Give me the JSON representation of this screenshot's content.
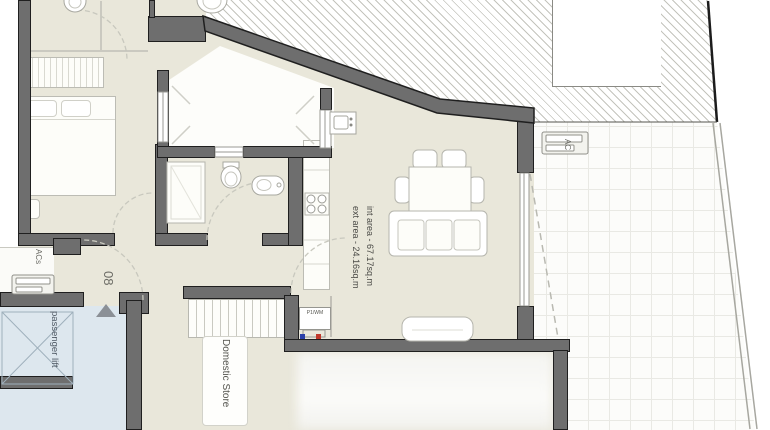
{
  "plan": {
    "title": "apartment-floor-plan",
    "int_area_label": "int area - 67.17sq.m",
    "ext_area_label": "ext area - 24.16sq.m",
    "unit_number": "08",
    "lift_label": "passenger lift",
    "store_label": "Domestic Store",
    "ac_unit_terrace_label": "AC",
    "ac_unit_facade_label": "ACs",
    "washer_label": "P1/WM"
  },
  "colors": {
    "interior_floor": "#e9e7da",
    "wall_fill": "#6e6e6e",
    "wall_outline": "#1f1f1f",
    "terrace_tile": "#fcfcfa",
    "lift_fill": "#dde7ee",
    "hatch_line": "#c4c4bd",
    "hot_water": "#c0392b",
    "cold_water": "#2a3fa8",
    "label_text": "#4a4a46"
  }
}
